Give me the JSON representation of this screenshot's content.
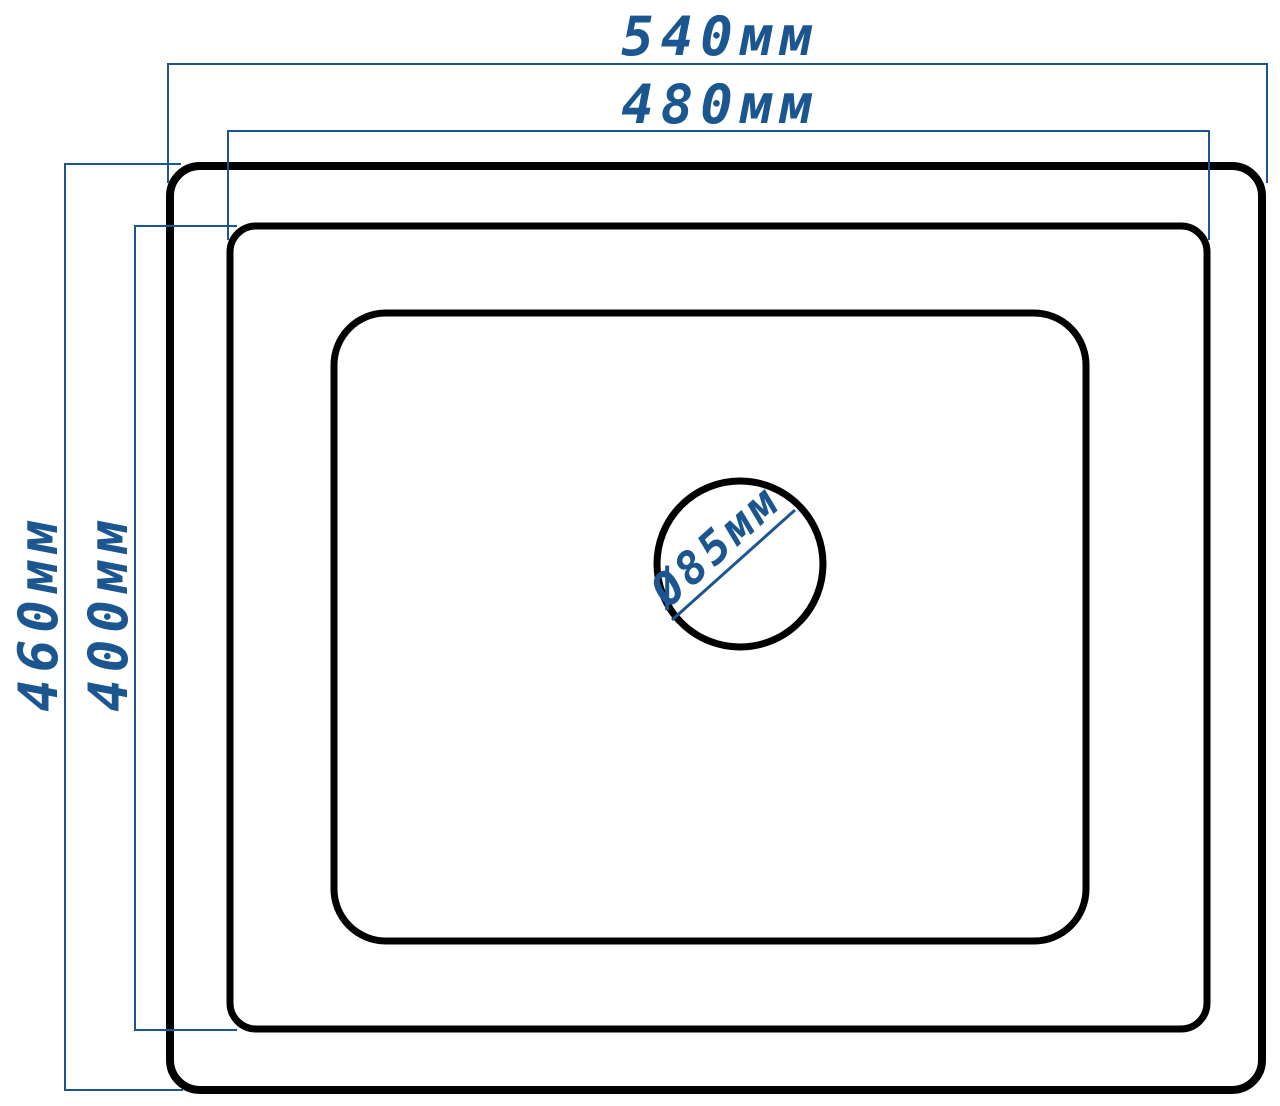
{
  "drawing": {
    "dimensions": {
      "outer_width": {
        "label": "540мм",
        "value_mm": 540
      },
      "rim_width": {
        "label": "480мм",
        "value_mm": 480
      },
      "outer_height": {
        "label": "460мм",
        "value_mm": 460
      },
      "rim_height": {
        "label": "400мм",
        "value_mm": 400
      },
      "drain_diameter": {
        "label": "Ø85мм",
        "value_mm": 85
      }
    },
    "colors": {
      "dimension_blue": "#1b5690",
      "outline_black": "#000000",
      "background": "#ffffff"
    }
  }
}
